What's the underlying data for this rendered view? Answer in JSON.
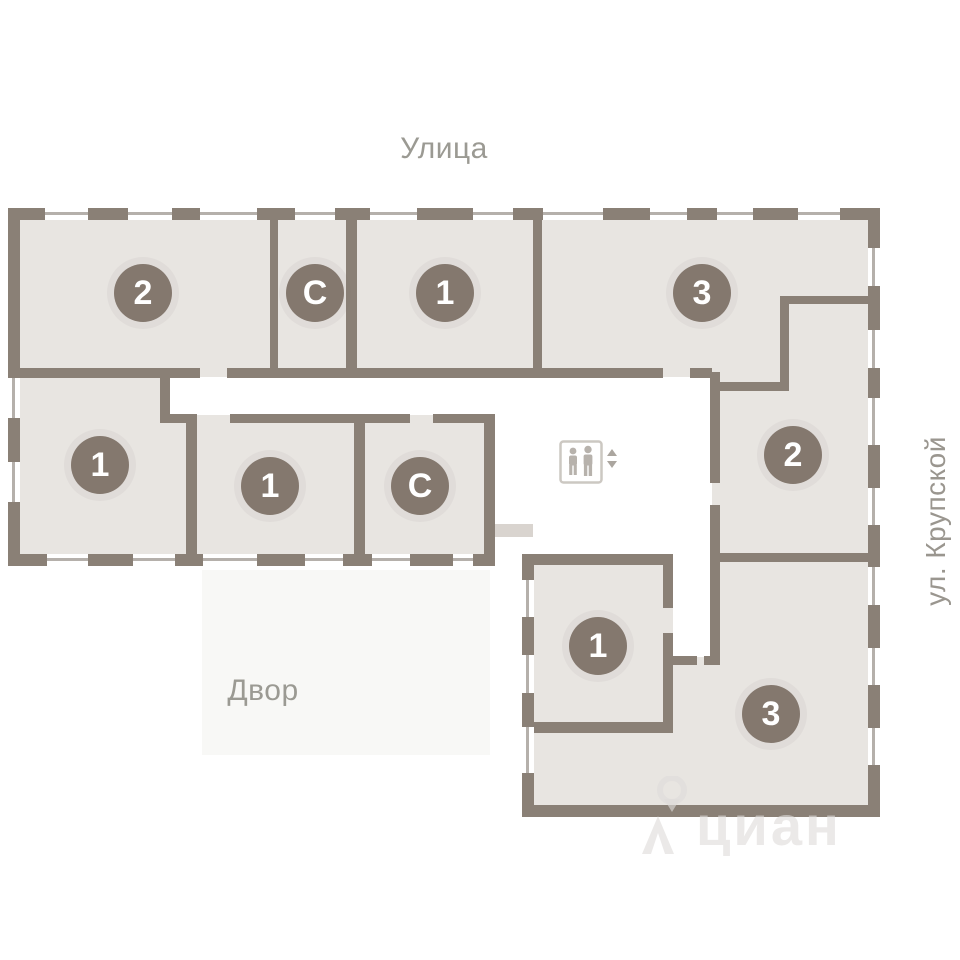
{
  "labels": {
    "street_top": "Улица",
    "courtyard": "Двор",
    "street_right": "ул. Крупской"
  },
  "watermark": {
    "brand": "циан",
    "icon": "location-pin-icon"
  },
  "colors": {
    "wall": "#8a8076",
    "room_fill": "#e8e5e1",
    "corridor": "#ffffff",
    "courtyard_tint": "#f8f8f6",
    "window_line": "#b5b0ab",
    "badge": "#84786e",
    "badge_text": "#ffffff",
    "label_text": "#9b9a93",
    "canopy": "#d9d4cf"
  },
  "elevator": {
    "icon": "elevator-people-icon",
    "arrows": "up-down"
  },
  "rooms": [
    {
      "id": "room-2-top-left",
      "label": "2",
      "x": 143,
      "y": 293
    },
    {
      "id": "room-s-top",
      "label": "С",
      "x": 315,
      "y": 293
    },
    {
      "id": "room-1-top",
      "label": "1",
      "x": 445,
      "y": 293
    },
    {
      "id": "room-3-top-right",
      "label": "3",
      "x": 702,
      "y": 293
    },
    {
      "id": "room-1-mid-left",
      "label": "1",
      "x": 100,
      "y": 465
    },
    {
      "id": "room-1-mid",
      "label": "1",
      "x": 270,
      "y": 486
    },
    {
      "id": "room-s-mid",
      "label": "С",
      "x": 420,
      "y": 486
    },
    {
      "id": "room-2-right",
      "label": "2",
      "x": 793,
      "y": 455
    },
    {
      "id": "room-1-bottom",
      "label": "1",
      "x": 598,
      "y": 646
    },
    {
      "id": "room-3-bottom",
      "label": "3",
      "x": 771,
      "y": 714
    }
  ]
}
